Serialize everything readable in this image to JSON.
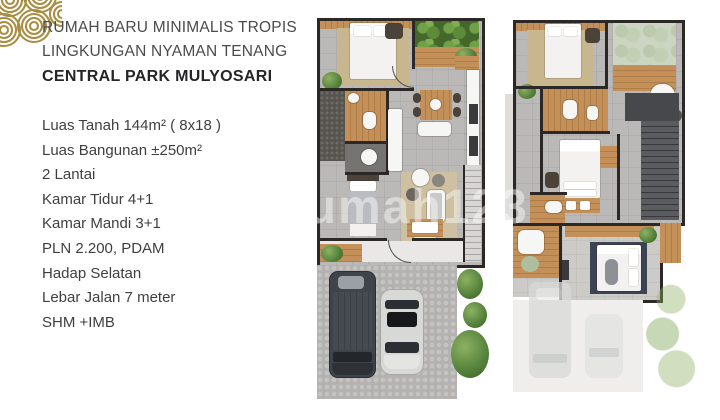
{
  "header": {
    "line1": "RUMAH BARU MINIMALIS TROPIS",
    "line2": "LINGKUNGAN NYAMAN TENANG",
    "title": "CENTRAL PARK MULYOSARI"
  },
  "specs": {
    "items": [
      "Luas Tanah 144m² ( 8x18 )",
      "Luas Bangunan ±250m²",
      "2 Lantai",
      "Kamar Tidur 4+1",
      "Kamar Mandi 3+1",
      "PLN 2.200, PDAM",
      "Hadap Selatan",
      "Lebar Jalan 7 meter",
      "SHM +IMB"
    ]
  },
  "watermark": {
    "text": "rumah123"
  },
  "logo": {
    "icon": "concentric-rings-logo",
    "color": "#a88d42"
  },
  "colors": {
    "accent_gold": "#a88d42",
    "heading_text": "#4b4b4d",
    "title_text": "#252528",
    "wall": "#2b2826",
    "wood": "#c49059",
    "greenery": "#54823a",
    "tile": "#bab9b7",
    "master_rug": "#3c4352",
    "suv_body": "#3f444a",
    "car_body": "#d8d8d6"
  }
}
